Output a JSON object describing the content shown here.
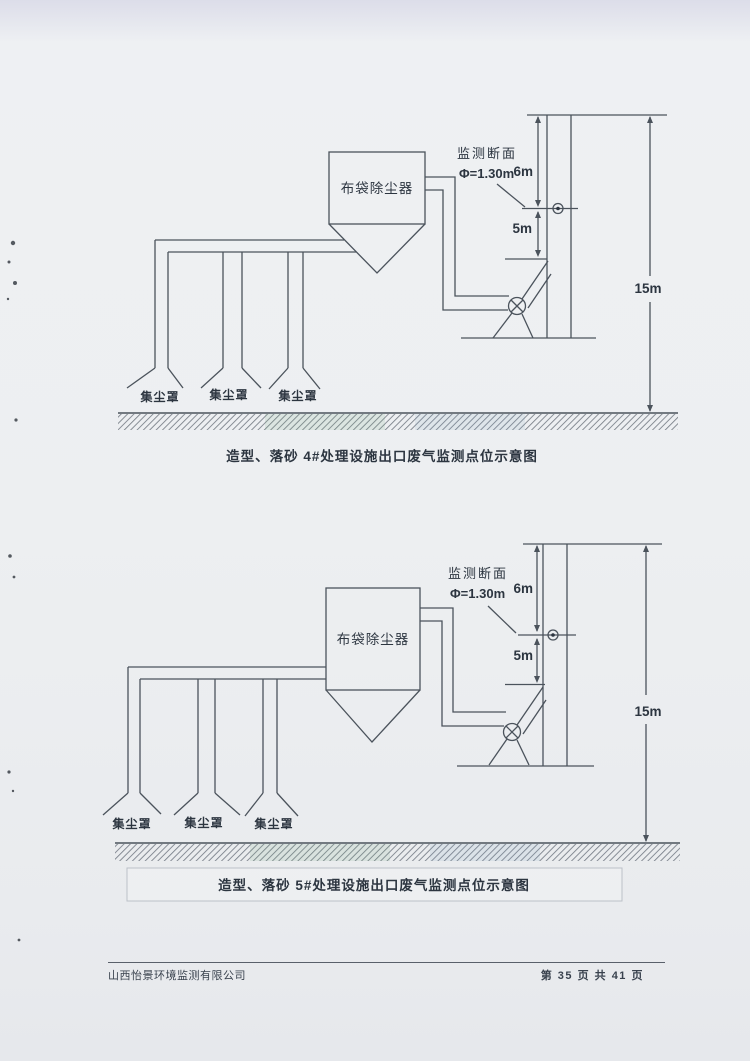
{
  "colors": {
    "line": "#4b535c",
    "text": "#2c3540",
    "paper": "#edeff1"
  },
  "diagram_top": {
    "collector": "布袋除尘器",
    "hoods": [
      "集尘罩",
      "集尘罩",
      "集尘罩"
    ],
    "section": "监测断面",
    "diameter": "Φ=1.30m",
    "dim_upper": "6m",
    "dim_lower": "5m",
    "stack_height": "15m",
    "caption": "造型、落砂 4#处理设施出口废气监测点位示意图"
  },
  "diagram_bottom": {
    "collector": "布袋除尘器",
    "hoods": [
      "集尘罩",
      "集尘罩",
      "集尘罩"
    ],
    "section": "监测断面",
    "diameter": "Φ=1.30m",
    "dim_upper": "6m",
    "dim_lower": "5m",
    "stack_height": "15m",
    "caption": "造型、落砂 5#处理设施出口废气监测点位示意图"
  },
  "footer": {
    "company": "山西怡景环境监测有限公司",
    "page_info": "第 35 页 共 41 页"
  }
}
